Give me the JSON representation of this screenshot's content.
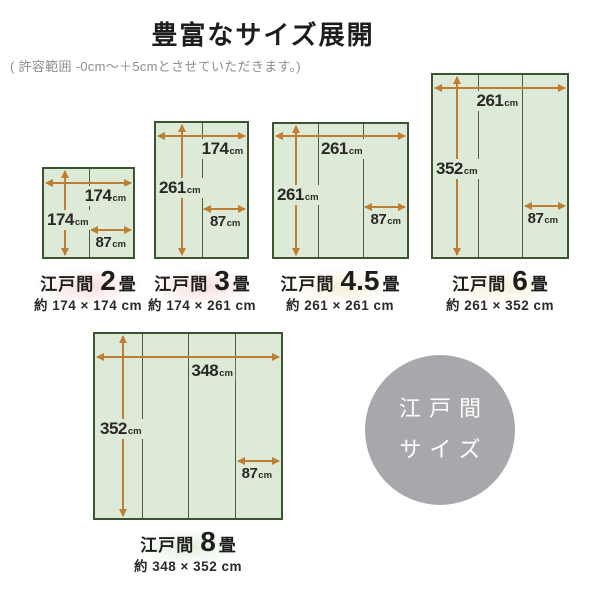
{
  "title": "豊富なサイズ展開",
  "subtitle": "( 許容範囲 -0cm〜＋5cmとさせていただきます。)",
  "unit": "cm",
  "diagrams": [
    {
      "region": "江戸間",
      "mats": "2",
      "mat_unit": "畳",
      "size_label": "約 174 × 174 cm",
      "width": "174",
      "height": "174",
      "half": "87",
      "panels": 2
    },
    {
      "region": "江戸間",
      "mats": "3",
      "mat_unit": "畳",
      "size_label": "約 174 × 261 cm",
      "width": "174",
      "height": "261",
      "half": "87",
      "panels": 2
    },
    {
      "region": "江戸間",
      "mats": "4.5",
      "mat_unit": "畳",
      "size_label": "約 261 × 261 cm",
      "width": "261",
      "height": "261",
      "half": "87",
      "panels": 3
    },
    {
      "region": "江戸間",
      "mats": "6",
      "mat_unit": "畳",
      "size_label": "約 261 × 352 cm",
      "width": "261",
      "height": "352",
      "half": "87",
      "panels": 3
    },
    {
      "region": "江戸間",
      "mats": "8",
      "mat_unit": "畳",
      "size_label": "約 348 × 352 cm",
      "width": "348",
      "height": "352",
      "half": "87",
      "panels": 4
    }
  ],
  "badge": {
    "line1": "江戸間",
    "line2": "サイズ"
  },
  "colors": {
    "mat_fill": "#dcead7",
    "mat_border": "#3a5530",
    "arrow": "#bd7e34",
    "badge_gray": "#a8a7ab",
    "glow_pink": "#f6dcda",
    "glow_cream": "#f6efd7",
    "glow_green": "#e3efdd",
    "subtitle_gray": "#8e8e8e"
  }
}
